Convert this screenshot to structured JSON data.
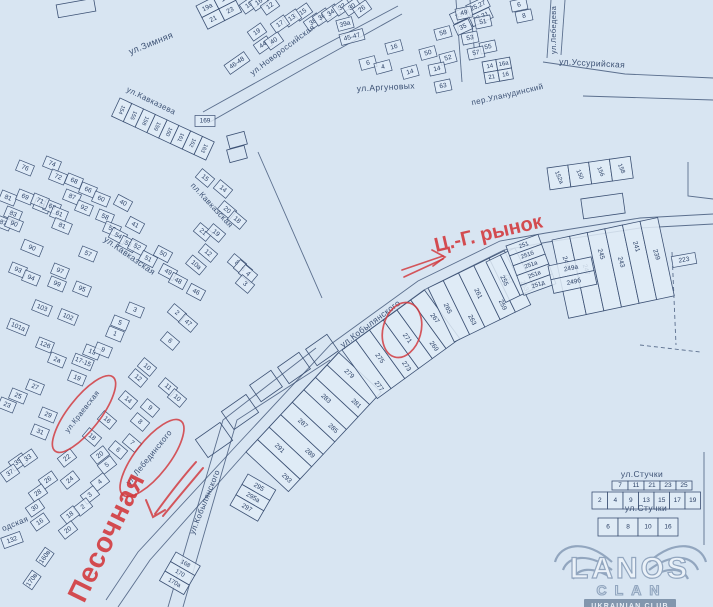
{
  "colors": {
    "bg": "#d8e5f2",
    "ink": "#3c5174",
    "num": "#2c4166",
    "parcel_fill": "#e1ecf7",
    "red": "#d23539",
    "wm_line": "#92a6bf",
    "wm_fill": "#eaf1f8",
    "wm_band_bg": "#8296ad",
    "wm_band_text": "#e7eef5"
  },
  "roads": [
    {
      "d": "M118,607 L150,560 L246,452 L339,352 L424,290 L504,250 L548,242 L640,228 L713,224"
    },
    {
      "d": "M106,600 L138,552 L236,446 L331,344 L418,281 L500,241 L546,233 L640,218 L713,214"
    },
    {
      "d": "M316,348 L223,420 L168,607"
    },
    {
      "d": "M330,360 L237,420 L183,607"
    },
    {
      "d": "M203,112 L300,58 L398,6"
    },
    {
      "d": "M210,122 L305,68 L402,14"
    },
    {
      "d": "M543,62 L625,74 L713,78"
    },
    {
      "d": "M583,96 L713,100"
    },
    {
      "d": "M551,0 L547,58"
    },
    {
      "d": "M565,0 L561,55"
    },
    {
      "d": "M456,0 L462,82"
    },
    {
      "d": "M470,0 L475,58"
    },
    {
      "d": "M258,152 L322,298"
    },
    {
      "d": "M704,452 L704,545"
    },
    {
      "d": "M688,162 L688,196 L713,199"
    },
    {
      "d": "M672,252 L676,345",
      "dash": "4 3"
    },
    {
      "d": "M640,345 L700,352",
      "dash": "4 3"
    }
  ],
  "building_outlines": [
    {
      "x": 76,
      "y": 8,
      "w": 38,
      "h": 13,
      "r": -10
    },
    {
      "x": 603,
      "y": 206,
      "w": 42,
      "h": 20,
      "r": -8
    },
    {
      "x": 266,
      "y": 386,
      "w": 26,
      "h": 20,
      "r": -35
    },
    {
      "x": 294,
      "y": 368,
      "w": 26,
      "h": 20,
      "r": -35
    },
    {
      "x": 322,
      "y": 350,
      "w": 26,
      "h": 20,
      "r": -35
    },
    {
      "x": 240,
      "y": 412,
      "w": 30,
      "h": 22,
      "r": -35
    },
    {
      "x": 214,
      "y": 440,
      "w": 30,
      "h": 22,
      "r": -35
    },
    {
      "x": 237,
      "y": 140,
      "w": 18,
      "h": 13,
      "r": -15
    },
    {
      "x": 237,
      "y": 154,
      "w": 18,
      "h": 13,
      "r": -15
    }
  ],
  "parcel_groups": [
    {
      "x": 196,
      "y": 6,
      "r": -27,
      "cw": 19,
      "ch": 13,
      "rows": [
        [
          "19а",
          "1в"
        ],
        [
          "21",
          "23"
        ]
      ]
    },
    {
      "x": 120,
      "y": 98,
      "r": 25,
      "cw": 13,
      "ch": 20,
      "nr": 90,
      "fs": 5.5,
      "rows": [
        [
          "154",
          "155",
          "158",
          "159",
          "160",
          "161",
          "162",
          "163"
        ]
      ]
    },
    {
      "x": 246,
      "y": 452,
      "r": -47,
      "cw": 17,
      "ch": 58,
      "nr": 90,
      "stag": [
        0.82,
        0.38
      ],
      "rows": [
        [
          "293",
          "291",
          "289",
          "287",
          "285",
          "283",
          "281",
          "279"
        ]
      ]
    },
    {
      "x": 342,
      "y": 350,
      "r": -36,
      "cw": 17,
      "ch": 60,
      "nr": 90,
      "stag": [
        0.85,
        0.48
      ],
      "rows": [
        [
          "277",
          "275",
          "273",
          "271",
          "269",
          "267"
        ]
      ]
    },
    {
      "x": 428,
      "y": 288,
      "r": -26,
      "cw": 17,
      "ch": 60,
      "nr": 90,
      "stag": [
        0.45,
        0.8
      ],
      "rows": [
        [
          "265",
          "263",
          "261",
          "259",
          "257"
        ]
      ]
    },
    {
      "x": 486,
      "y": 262,
      "r": -26,
      "cw": 16,
      "ch": 45,
      "nr": 90,
      "stag": [
        0.55,
        0.85
      ],
      "rows": [
        [
          "255",
          "253"
        ]
      ]
    },
    {
      "x": 506,
      "y": 246,
      "r": -20,
      "cw": 34,
      "ch": 10.5,
      "fs": 6,
      "rows": [
        [
          "251"
        ],
        [
          "251б"
        ],
        [
          "251а"
        ],
        [
          "251в"
        ],
        [
          "251д"
        ]
      ]
    },
    {
      "x": 552,
      "y": 240,
      "r": -12,
      "cw": 18,
      "ch": 80,
      "nr": 85,
      "stag": [
        0.3,
        0.45
      ],
      "rows": [
        [
          "249",
          "247",
          "245",
          "243",
          "241",
          "239"
        ]
      ]
    },
    {
      "x": 548,
      "y": 266,
      "r": -12,
      "cw": 44,
      "ch": 14,
      "fs": 6.5,
      "rows": [
        [
          "249а"
        ],
        [
          "249б"
        ]
      ]
    },
    {
      "x": 482,
      "y": 62,
      "r": -10,
      "cw": 14,
      "ch": 11,
      "fs": 6,
      "rows": [
        [
          "14",
          "16а"
        ],
        [
          "21",
          "16"
        ]
      ]
    },
    {
      "x": 612,
      "y": 481,
      "cw": 16,
      "ch": 9,
      "fs": 6.5,
      "rows": [
        [
          "7",
          "11",
          "21",
          "23",
          "25"
        ]
      ]
    },
    {
      "x": 592,
      "y": 492,
      "cw": 15.5,
      "ch": 17,
      "fs": 6.5,
      "rows": [
        [
          "2",
          "4",
          "9",
          "13",
          "15",
          "17",
          "19"
        ]
      ]
    },
    {
      "x": 598,
      "y": 518,
      "cw": 20,
      "ch": 18,
      "fs": 6.5,
      "rows": [
        [
          "6",
          "8",
          "10",
          "16"
        ]
      ]
    },
    {
      "x": 547,
      "y": 168,
      "r": -8,
      "cw": 21,
      "ch": 22,
      "fs": 6,
      "nr": 75,
      "rows": [
        [
          "152а",
          "150",
          "156",
          "158"
        ]
      ]
    },
    {
      "x": 248,
      "y": 474,
      "r": 30,
      "cw": 32,
      "ch": 12,
      "fs": 6.5,
      "rows": [
        [
          "295"
        ],
        [
          "295а"
        ],
        [
          "297"
        ]
      ]
    },
    {
      "x": 176,
      "y": 552,
      "r": 30,
      "cw": 28,
      "ch": 11,
      "fs": 6,
      "rows": [
        [
          "168"
        ],
        [
          "170"
        ],
        [
          "170а"
        ]
      ]
    }
  ],
  "parcels_nxyrw": [
    [
      "10",
      249,
      5,
      -35
    ],
    [
      "16",
      259,
      2,
      -35
    ],
    [
      "12",
      270,
      6,
      -35
    ],
    [
      "15",
      303,
      12,
      -35
    ],
    [
      "13",
      292,
      18,
      -35
    ],
    [
      "17",
      280,
      24,
      -35
    ],
    [
      "19",
      257,
      32,
      -35
    ],
    [
      "44",
      263,
      45,
      -35
    ],
    [
      "40",
      274,
      41,
      -35
    ],
    [
      "46-48",
      237,
      63,
      -35,
      24
    ],
    [
      "38",
      313,
      22,
      -35
    ],
    [
      "36",
      322,
      17,
      -35
    ],
    [
      "34",
      331,
      13,
      -35
    ],
    [
      "32",
      342,
      7,
      -35
    ],
    [
      "30",
      352,
      7,
      -35
    ],
    [
      "26",
      362,
      9,
      -35
    ],
    [
      "39а",
      345,
      24,
      -15
    ],
    [
      "45-47",
      352,
      37,
      -15,
      24
    ],
    [
      "16",
      394,
      47,
      -15
    ],
    [
      "6",
      368,
      63,
      -15
    ],
    [
      "4",
      383,
      67,
      -15
    ],
    [
      "14",
      410,
      72,
      -15
    ],
    [
      "58",
      443,
      33,
      -15
    ],
    [
      "50",
      428,
      53,
      -15
    ],
    [
      "52",
      448,
      58,
      -15
    ],
    [
      "35",
      463,
      27,
      -25
    ],
    [
      "33",
      459,
      16,
      -25
    ],
    [
      "29,31",
      481,
      17,
      -25,
      22
    ],
    [
      "25,27",
      478,
      6,
      -25,
      22
    ],
    [
      "49",
      464,
      13,
      -12
    ],
    [
      "51",
      483,
      22,
      -12
    ],
    [
      "53",
      470,
      38,
      -12
    ],
    [
      "55",
      488,
      47,
      -12
    ],
    [
      "57",
      476,
      53,
      -12
    ],
    [
      "8",
      524,
      16,
      -12
    ],
    [
      "6",
      519,
      5,
      -12
    ],
    [
      "14",
      437,
      69,
      -12
    ],
    [
      "63",
      443,
      86,
      -12
    ],
    [
      "169",
      205,
      121,
      0,
      20
    ],
    [
      "76",
      25,
      168,
      22
    ],
    [
      "74",
      52,
      164,
      22
    ],
    [
      "72",
      58,
      177,
      22
    ],
    [
      "68",
      74,
      181,
      22
    ],
    [
      "66",
      88,
      190,
      22
    ],
    [
      "87",
      72,
      197,
      22
    ],
    [
      "92",
      84,
      208,
      22
    ],
    [
      "60",
      101,
      199,
      22
    ],
    [
      "58",
      105,
      217,
      22
    ],
    [
      "56",
      112,
      229,
      22
    ],
    [
      "65",
      42,
      206,
      22
    ],
    [
      "63",
      52,
      207,
      22
    ],
    [
      "61",
      59,
      214,
      22
    ],
    [
      "81",
      8,
      198,
      22
    ],
    [
      "69",
      25,
      197,
      22
    ],
    [
      "71",
      40,
      201,
      22
    ],
    [
      "83",
      13,
      214,
      22
    ],
    [
      "87",
      3,
      223,
      22
    ],
    [
      "90",
      14,
      224,
      22
    ],
    [
      "90",
      32,
      248,
      22,
      20
    ],
    [
      "93",
      18,
      270,
      22
    ],
    [
      "94",
      31,
      278,
      22
    ],
    [
      "97",
      60,
      271,
      22
    ],
    [
      "99",
      57,
      284,
      22
    ],
    [
      "95",
      82,
      289,
      22
    ],
    [
      "57",
      88,
      254,
      22
    ],
    [
      "81",
      62,
      226,
      22,
      18
    ],
    [
      "40",
      123,
      203,
      28
    ],
    [
      "41",
      135,
      225,
      28
    ],
    [
      "54",
      118,
      236,
      28
    ],
    [
      "53",
      128,
      244,
      28
    ],
    [
      "52",
      137,
      247,
      28
    ],
    [
      "50",
      163,
      254,
      28
    ],
    [
      "51",
      148,
      259,
      28
    ],
    [
      "49",
      168,
      272,
      28
    ],
    [
      "48",
      178,
      281,
      28
    ],
    [
      "46",
      196,
      292,
      28
    ],
    [
      "15",
      205,
      178,
      40
    ],
    [
      "14",
      223,
      189,
      40
    ],
    [
      "20",
      227,
      210,
      40
    ],
    [
      "18",
      237,
      220,
      40
    ],
    [
      "21",
      203,
      232,
      40
    ],
    [
      "19",
      216,
      233,
      40
    ],
    [
      "12",
      208,
      253,
      40
    ],
    [
      "10а",
      196,
      265,
      40,
      18
    ],
    [
      "8",
      237,
      263,
      40
    ],
    [
      "6",
      243,
      269,
      40
    ],
    [
      "4",
      248,
      274,
      40
    ],
    [
      "3",
      245,
      284,
      40
    ],
    [
      "103",
      42,
      308,
      22,
      18
    ],
    [
      "102",
      68,
      317,
      22,
      18
    ],
    [
      "101а",
      18,
      327,
      22,
      20
    ],
    [
      "12б",
      45,
      345,
      22
    ],
    [
      "2а",
      57,
      360,
      22
    ],
    [
      "17-15",
      83,
      362,
      22,
      20
    ],
    [
      "13",
      92,
      352,
      22
    ],
    [
      "9",
      103,
      350,
      22
    ],
    [
      "5",
      120,
      323,
      22
    ],
    [
      "1",
      115,
      334,
      22
    ],
    [
      "3",
      135,
      310,
      22
    ],
    [
      "19",
      77,
      378,
      22
    ],
    [
      "27",
      35,
      387,
      22
    ],
    [
      "25",
      18,
      396,
      22
    ],
    [
      "23",
      7,
      405,
      22
    ],
    [
      "29",
      48,
      415,
      22
    ],
    [
      "31",
      40,
      432,
      22
    ],
    [
      "2",
      177,
      313,
      40
    ],
    [
      "47",
      188,
      323,
      40
    ],
    [
      "6",
      170,
      341,
      40
    ],
    [
      "10",
      147,
      367,
      40
    ],
    [
      "12",
      138,
      378,
      40
    ],
    [
      "11",
      168,
      387,
      40
    ],
    [
      "10",
      177,
      398,
      40
    ],
    [
      "9",
      150,
      408,
      40
    ],
    [
      "8",
      140,
      422,
      40
    ],
    [
      "14",
      128,
      400,
      40
    ],
    [
      "16",
      107,
      420,
      40
    ],
    [
      "18",
      92,
      437,
      40
    ],
    [
      "7",
      132,
      443,
      40
    ],
    [
      "6",
      118,
      450,
      40
    ],
    [
      "20",
      100,
      455,
      -38
    ],
    [
      "22",
      67,
      458,
      -38
    ],
    [
      "24",
      70,
      480,
      -38
    ],
    [
      "5",
      107,
      465,
      -38
    ],
    [
      "4",
      100,
      482,
      -38
    ],
    [
      "3",
      90,
      495,
      -38
    ],
    [
      "2",
      83,
      507,
      -38
    ],
    [
      "18",
      70,
      515,
      -38
    ],
    [
      "20",
      68,
      530,
      -38
    ],
    [
      "35",
      18,
      462,
      -35
    ],
    [
      "33",
      28,
      458,
      -35
    ],
    [
      "37",
      10,
      473,
      -35
    ],
    [
      "26",
      48,
      480,
      -35
    ],
    [
      "28",
      38,
      493,
      -35
    ],
    [
      "30",
      35,
      508,
      -35
    ],
    [
      "16",
      40,
      522,
      -35
    ],
    [
      "132",
      12,
      540,
      -20,
      20
    ],
    [
      "160в",
      45,
      557,
      -55
    ],
    [
      "170в",
      32,
      580,
      -55
    ],
    [
      "223",
      684,
      260,
      -10,
      24
    ]
  ],
  "streets": [
    {
      "t": "ул.Зимняя",
      "x": 152,
      "y": 46,
      "r": -22,
      "s": 9
    },
    {
      "t": "ул.Новороссийская",
      "x": 284,
      "y": 52,
      "r": -37,
      "s": 8
    },
    {
      "t": "ул.Аргуновых",
      "x": 386,
      "y": 90,
      "r": -3,
      "s": 8.5
    },
    {
      "t": "ул.Уссурийская",
      "x": 592,
      "y": 66,
      "r": 3,
      "s": 8.5
    },
    {
      "t": "ул.Лебедева",
      "x": 556,
      "y": 30,
      "r": -90,
      "s": 7.5
    },
    {
      "t": "пер.Уланудинский",
      "x": 508,
      "y": 97,
      "r": -13,
      "s": 8
    },
    {
      "t": "ул.Кавказева",
      "x": 150,
      "y": 103,
      "r": 26,
      "s": 8
    },
    {
      "t": "ул.Кавказская",
      "x": 128,
      "y": 258,
      "r": 35,
      "s": 8.5
    },
    {
      "t": "пл.Кавказская",
      "x": 210,
      "y": 207,
      "r": 47,
      "s": 8
    },
    {
      "t": "ул.Кобылянского",
      "x": 372,
      "y": 326,
      "r": -37,
      "s": 8.5
    },
    {
      "t": "ул.Кобылянского",
      "x": 207,
      "y": 503,
      "r": -68,
      "s": 8
    },
    {
      "t": "ул.Лебединского",
      "x": 151,
      "y": 459,
      "r": -51,
      "s": 8
    },
    {
      "t": "ул.Стучки",
      "x": 642,
      "y": 477,
      "r": 0,
      "s": 8.5
    },
    {
      "t": "ул.Стучки",
      "x": 646,
      "y": 511,
      "r": 0,
      "s": 8.5
    },
    {
      "t": "одская",
      "x": 16,
      "y": 526,
      "r": -22,
      "s": 8
    },
    {
      "t": "ул.Краевская",
      "x": 84,
      "y": 413,
      "r": -52,
      "s": 7.5
    }
  ],
  "annotations": {
    "market_label": {
      "t": "Ц.-Г. рынок",
      "x": 436,
      "y": 252,
      "r": -13,
      "s": 20
    },
    "market_arrow": {
      "lines": [
        "M404,277 L443,259",
        "M402,270 L443,256"
      ],
      "head": "M432,250 L445,257 L433,266"
    },
    "pesochnaya_label": {
      "t": "Песочная",
      "x": 84,
      "y": 604,
      "r": -64,
      "s": 28
    },
    "curved_arrow": {
      "lines": [
        "M196,462 C180,480 168,496 155,514",
        "M203,468 C188,486 176,500 163,516"
      ],
      "head": "M146,500 L153,517 L165,510"
    },
    "ellipses": [
      {
        "cx": 402,
        "cy": 330,
        "rx": 19,
        "ry": 28,
        "r": 15
      },
      {
        "cx": 84,
        "cy": 414,
        "rx": 16,
        "ry": 47,
        "r": 38
      },
      {
        "cx": 152,
        "cy": 458,
        "rx": 17,
        "ry": 47,
        "r": 38
      }
    ]
  },
  "watermark": {
    "title": "LANOS",
    "subtitle": "CLAN",
    "band": "UKRAINIAN CLUB"
  }
}
